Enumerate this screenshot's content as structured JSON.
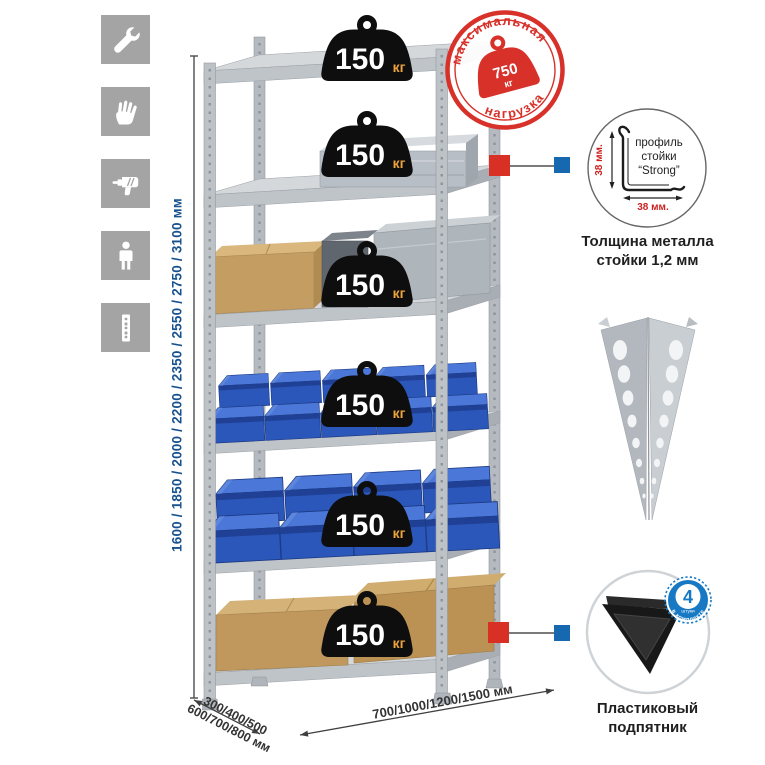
{
  "page": {
    "background": "#ffffff"
  },
  "assembly_icons": [
    {
      "name": "wrench"
    },
    {
      "name": "gloves"
    },
    {
      "name": "drill"
    },
    {
      "name": "person-height"
    },
    {
      "name": "perforated-post"
    }
  ],
  "dimensions": {
    "height_label": "1600 / 1850 / 2000 / 2200 / 2350 / 2550 / 2750 / 3100 мм",
    "depth_label_line1": "300/400/500",
    "depth_label_line2": "600/700/800 мм",
    "width_label": "700/1000/1200/1500 мм"
  },
  "shelf_load_badge": {
    "value": "150",
    "unit": "кг",
    "count": 6
  },
  "max_load_stamp": {
    "arc_top": "максимальная",
    "arc_bottom": "нагрузка",
    "value": "750",
    "unit": "кг"
  },
  "profile_callout": {
    "label_line1": "профиль",
    "label_line2": "стойки",
    "label_line3": "“Strong”",
    "vertical_dim": "38 мм.",
    "horizontal_dim": "38 мм.",
    "caption_line1": "Толщина металла",
    "caption_line2": "стойки 1,2 мм"
  },
  "foot_callout": {
    "badge_value": "4",
    "badge_unit": "штуки",
    "badge_arc_text": "в комплекте",
    "caption_line1": "Пластиковый",
    "caption_line2": "подпятник"
  },
  "colors": {
    "stamp_red": "#d8312a",
    "dimension_blue": "#17518e",
    "bin_blue": "#2b57ba",
    "marker_red": "#d93026",
    "marker_blue": "#1668b0",
    "foot_badge_blue": "#1779c4",
    "weight_black": "#0e0e0e",
    "kg_orange": "#eda33c"
  }
}
